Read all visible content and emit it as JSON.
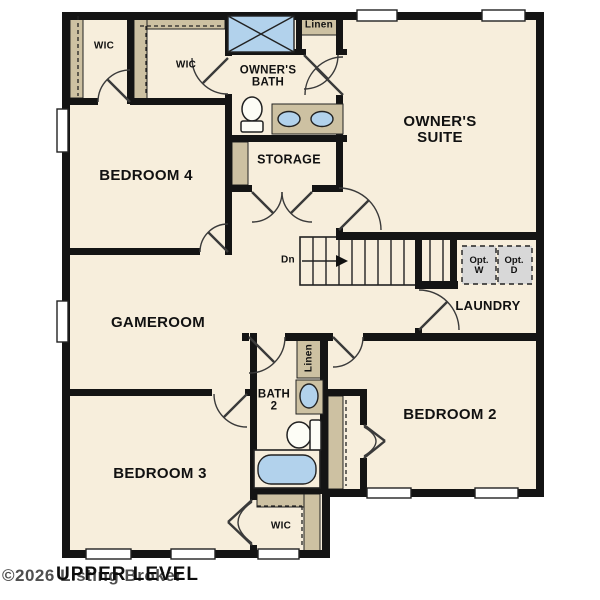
{
  "footer": {
    "watermark": "©2026 Listing Broker",
    "level_label": "UPPER LEVEL"
  },
  "rooms": {
    "wic_top_left": "WIC",
    "wic_top_mid": "WIC",
    "owners_bath_line1": "OWNER'S",
    "owners_bath_line2": "BATH",
    "linen_top": "Linen",
    "owners_suite_line1": "OWNER'S",
    "owners_suite_line2": "SUITE",
    "bedroom4": "BEDROOM 4",
    "storage": "STORAGE",
    "laundry": "LAUNDRY",
    "gameroom": "GAMEROOM",
    "linen_mid": "Linen",
    "bath2_line1": "BATH",
    "bath2_line2": "2",
    "bedroom2": "BEDROOM 2",
    "bedroom3": "BEDROOM 3",
    "wic_bottom": "WIC"
  },
  "stairs": {
    "direction_label": "Dn"
  },
  "laundry_options": {
    "washer_line1": "Opt.",
    "washer_line2": "W",
    "dryer_line1": "Opt.",
    "dryer_line2": "D"
  },
  "colors": {
    "floor": "#f7eedc",
    "wall": "#141414",
    "casework": "#cdc1a2",
    "blue": "#b2d2ec",
    "gray": "#d8d8d8",
    "line": "#222222",
    "watermark": "#4f4f4f"
  }
}
